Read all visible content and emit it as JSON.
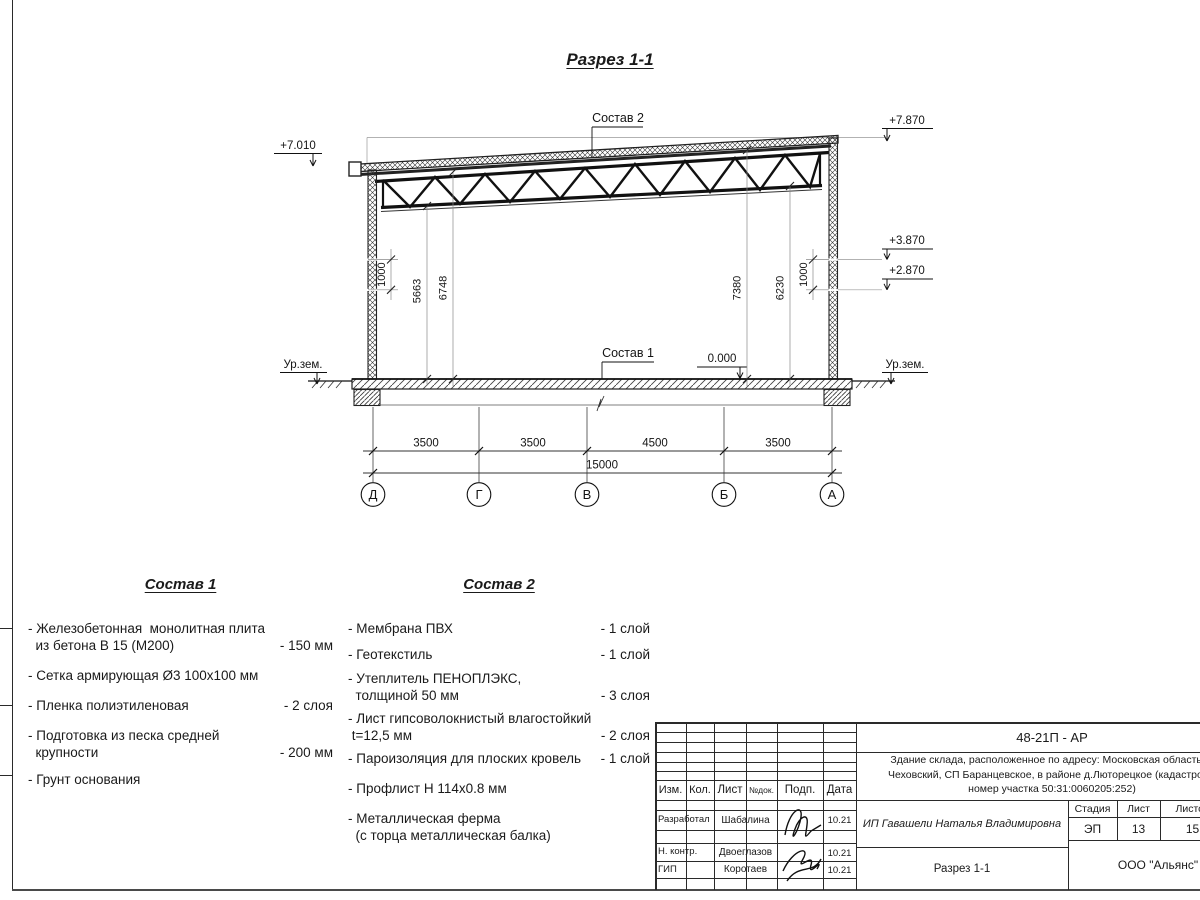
{
  "title": "Разрез 1-1",
  "section": {
    "sostav2_label": "Состав 2",
    "sostav1_label": "Состав 1",
    "elev_top_left": "+7.010",
    "elev_top_right": "+7.870",
    "elev_right_upper": "+3.870",
    "elev_right_lower": "+2.870",
    "elev_zero": "0.000",
    "ground_left": "Ур.зем.",
    "ground_right": "Ур.зем.",
    "dims_vertical": {
      "left_1000": "1000",
      "left_5663": "5663",
      "left_6748": "6748",
      "right_7380": "7380",
      "right_6230": "6230",
      "right_1000": "1000"
    },
    "dims_horizontal": [
      "3500",
      "3500",
      "4500",
      "3500"
    ],
    "dim_total": "15000",
    "axes": [
      "Д",
      "Г",
      "В",
      "Б",
      "А"
    ]
  },
  "sostav1": {
    "heading": "Состав 1",
    "items": [
      {
        "text": "- Железобетонная  монолитная плита\n  из бетона В 15 (М200)",
        "value": "- 150 мм"
      },
      {
        "text": "- Сетка армирующая Ø3 100х100 мм",
        "value": ""
      },
      {
        "text": "- Пленка полиэтиленовая",
        "value": "-  2 слоя"
      },
      {
        "text": "- Подготовка из песка средней\n  крупности",
        "value": "- 200 мм"
      },
      {
        "text": "- Грунт основания",
        "value": ""
      }
    ]
  },
  "sostav2": {
    "heading": "Состав 2",
    "items": [
      {
        "text": "- Мембрана ПВХ",
        "value": "- 1 слой"
      },
      {
        "text": "- Геотекстиль",
        "value": "- 1 слой"
      },
      {
        "text": "- Утеплитель ПЕНОПЛЭКС,\n  толщиной 50 мм",
        "value": "- 3 слоя"
      },
      {
        "text": "- Лист гипсоволокнистый влагостойкий\n t=12,5 мм",
        "value": "- 2 слоя"
      },
      {
        "text": "- Пароизоляция для плоских кровель",
        "value": "- 1 слой"
      },
      {
        "text": "- Профлист Н 114х0.8 мм",
        "value": ""
      },
      {
        "text": "- Металлическая ферма\n  (с торца металлическая балка)",
        "value": ""
      }
    ]
  },
  "stamp": {
    "doc_code": "48-21П - АР",
    "description": [
      "Здание склада, расположенное по адресу: Московская область, р",
      "Чеховский, СП Баранцевское, в районе д.Люторецкое  (кадастровы",
      "номер участка 50:31:0060205:252)"
    ],
    "columns": [
      "Изм.",
      "Кол.",
      "Лист",
      "№док.",
      "Подп.",
      "Дата"
    ],
    "rows": [
      {
        "role": "Разработал",
        "name": "Шабалина",
        "date": "10.21"
      },
      {
        "role": "Н. контр.",
        "name": "Двоеглазов",
        "date": "10.21"
      },
      {
        "role": "ГИП",
        "name": "Коротаев",
        "date": "10.21"
      }
    ],
    "client": "ИП Гавашели Наталья Владимировна",
    "stage_label": "Стадия",
    "sheet_label": "Лист",
    "sheets_label": "Листов",
    "stage": "ЭП",
    "sheet_number": "13",
    "sheets_total": "15",
    "drawing_title": "Разрез 1-1",
    "company": "ООО \"Альянс\""
  }
}
